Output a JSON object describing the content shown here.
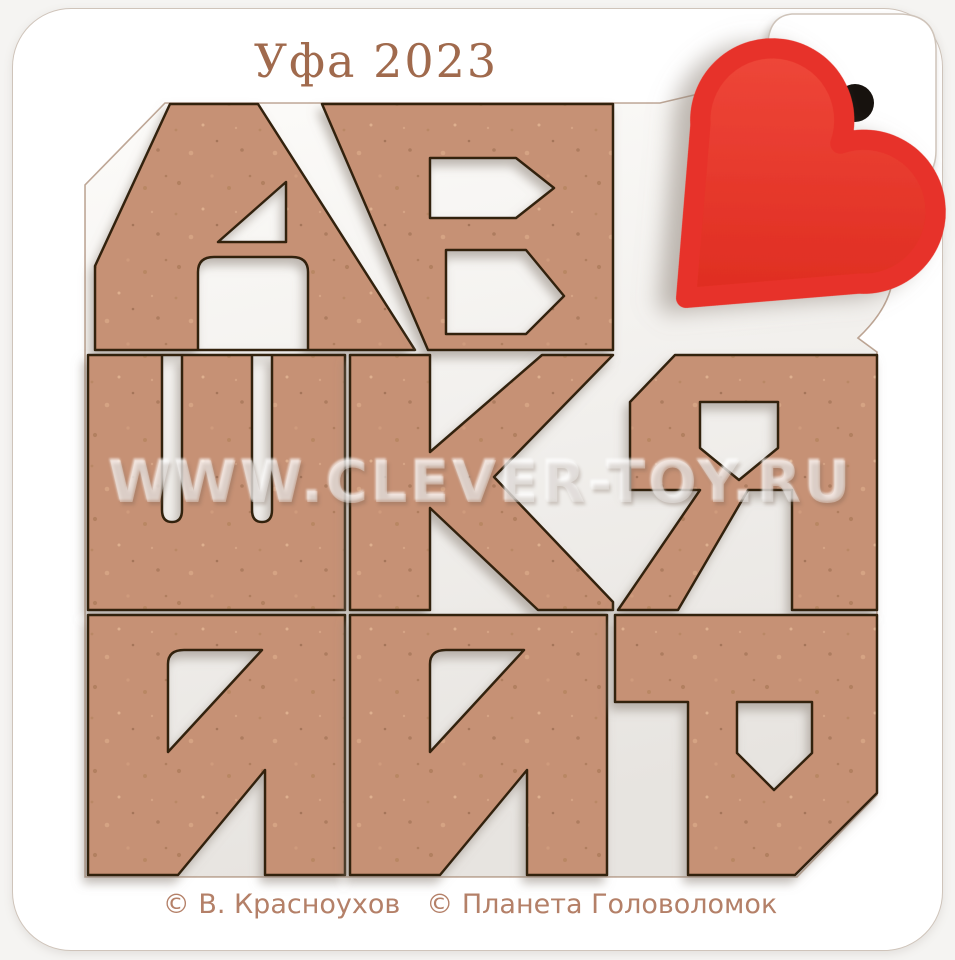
{
  "background_color": "#f5f4f2",
  "board": {
    "color": "#ffffff",
    "corner_radius_px": 58
  },
  "title": {
    "text": "Уфа 2023",
    "color": "#a06a4d"
  },
  "watermark": {
    "text": "WWW.CLEVER-TOY.RU"
  },
  "credits": {
    "author": "© В. Красноухов",
    "publisher": "© Планета  Головоломок",
    "color": "#b48068"
  },
  "puzzle": {
    "pieces": [
      {
        "letter": "А",
        "row": 1,
        "col": 1,
        "orientation": "upright"
      },
      {
        "letter": "Б",
        "row": 1,
        "col": 2,
        "orientation": "upright"
      },
      {
        "letter": "Ш",
        "row": 2,
        "col": 1,
        "orientation": "upright"
      },
      {
        "letter": "К",
        "row": 2,
        "col": 2,
        "orientation": "upright"
      },
      {
        "letter": "Я",
        "row": 2,
        "col": 3,
        "orientation": "upright"
      },
      {
        "letter": "И",
        "row": 3,
        "col": 1,
        "orientation": "upright"
      },
      {
        "letter": "И",
        "row": 3,
        "col": 2,
        "orientation": "upright"
      },
      {
        "letter": "Р",
        "row": 3,
        "col": 3,
        "orientation": "rotated-180"
      }
    ],
    "material_color": "#c69175",
    "outline_color": "#33200f",
    "recess_color": "#fdfcfa"
  },
  "heart": {
    "color": "#e73329"
  },
  "hang_hole": {
    "color": "#17120e"
  }
}
